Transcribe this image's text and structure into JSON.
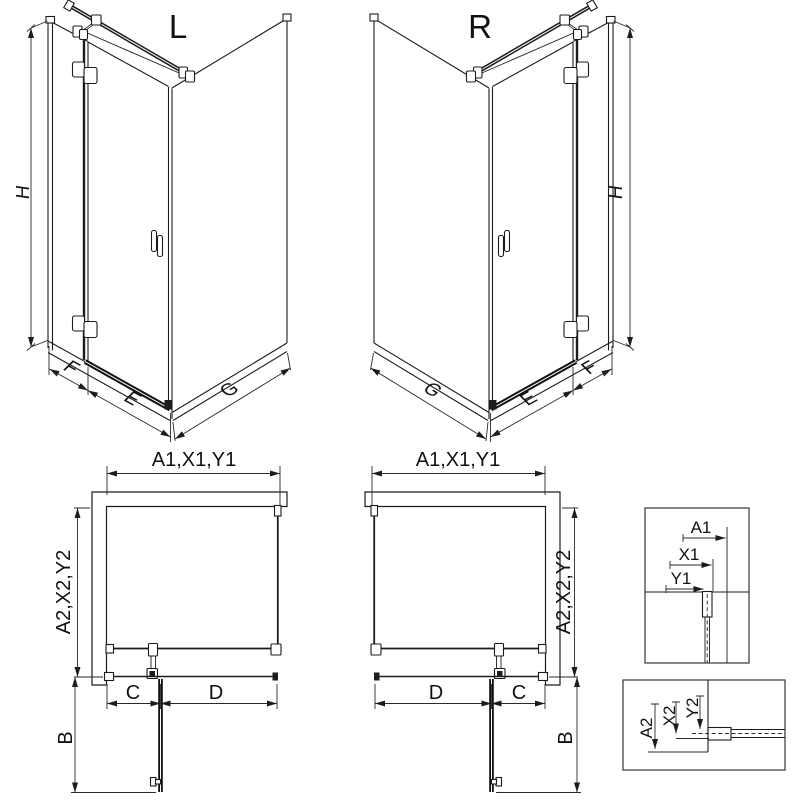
{
  "drawing": {
    "iso_left": {
      "title": "L",
      "height_label": "H",
      "fixed_width_label": "F",
      "door_width_label": "E",
      "side_width_label": "G"
    },
    "iso_right": {
      "title": "R",
      "height_label": "H",
      "fixed_width_label": "F",
      "door_width_label": "E",
      "side_width_label": "G"
    },
    "plan_left": {
      "width_label": "A1,X1,Y1",
      "depth_label": "A2,X2,Y2",
      "c_label": "C",
      "d_label": "D",
      "b_label": "B"
    },
    "plan_right": {
      "width_label": "A1,X1,Y1",
      "depth_label": "A2,X2,Y2",
      "c_label": "C",
      "d_label": "D",
      "b_label": "B"
    },
    "detail_width_offsets": {
      "a": "A1",
      "x": "X1",
      "y": "Y1"
    },
    "detail_depth_offsets": {
      "a": "A2",
      "x": "X2",
      "y": "Y2"
    }
  },
  "colors": {
    "line": "#1c1c1c",
    "dimension": "#2a2a2a",
    "background": "#ffffff"
  }
}
